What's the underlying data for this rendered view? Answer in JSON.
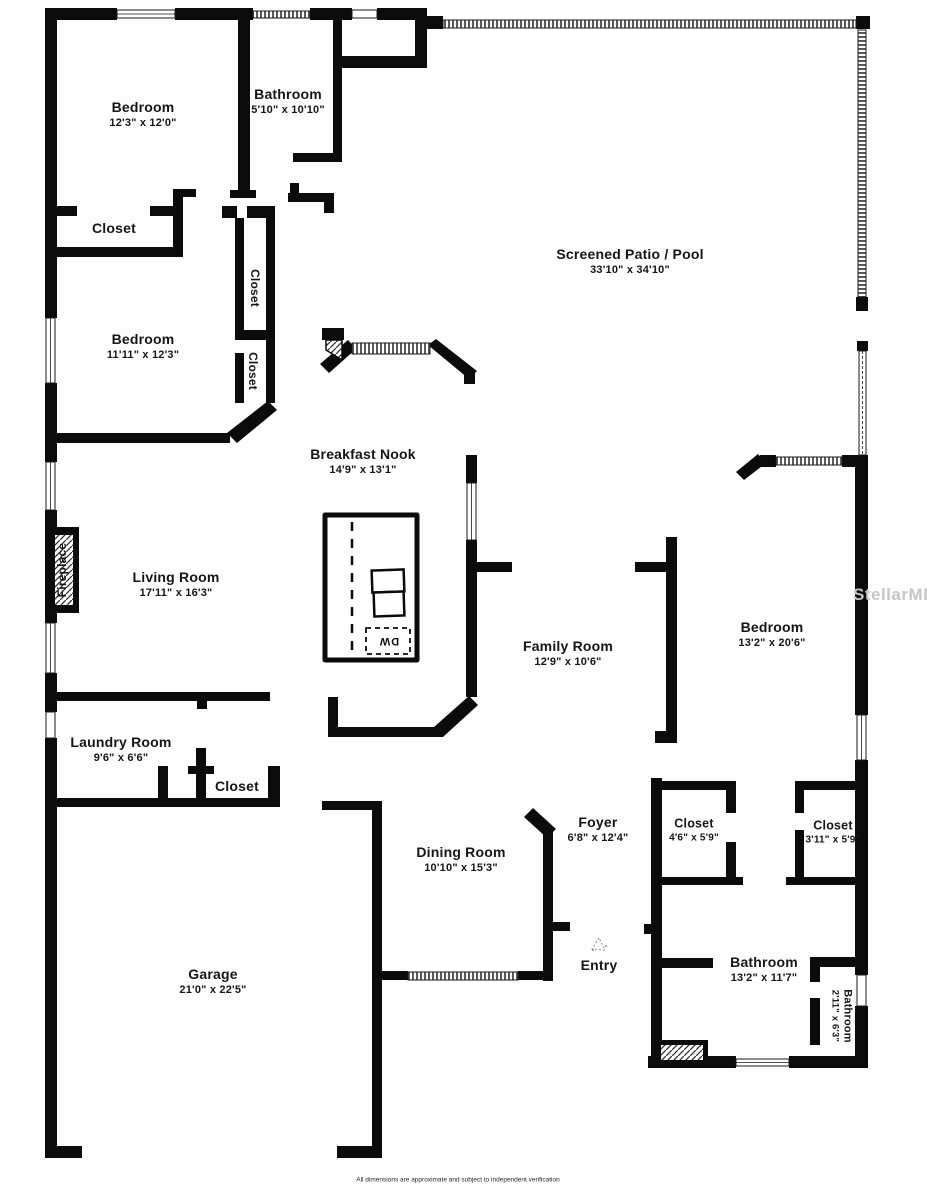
{
  "watermark": "StellarMLS",
  "disclaimer": "All dimensions are approximate and subject to independent verification",
  "colors": {
    "wall": "#0b0b0b",
    "label": "#161616",
    "watermark": "#c6c6c6",
    "background": "#fdfdfd"
  },
  "fixtures": {
    "dishwasher": "DW"
  },
  "rooms": [
    {
      "name": "Bedroom",
      "dims": "12'3\" x 12'0\""
    },
    {
      "name": "Bathroom",
      "dims": "5'10\" x 10'10\""
    },
    {
      "name": "Closet",
      "dims": ""
    },
    {
      "name": "Screened Patio / Pool",
      "dims": "33'10\" x 34'10\""
    },
    {
      "name": "Bedroom",
      "dims": "11'11\" x 12'3\""
    },
    {
      "name": "Closet",
      "dims": ""
    },
    {
      "name": "Closet",
      "dims": ""
    },
    {
      "name": "Breakfast Nook",
      "dims": "14'9\" x 13'1\""
    },
    {
      "name": "Living Room",
      "dims": "17'11\" x 16'3\""
    },
    {
      "name": "Fireplace",
      "dims": ""
    },
    {
      "name": "Family Room",
      "dims": "12'9\" x 10'6\""
    },
    {
      "name": "Bedroom",
      "dims": "13'2\" x 20'6\""
    },
    {
      "name": "Laundry Room",
      "dims": "9'6\" x 6'6\""
    },
    {
      "name": "Closet",
      "dims": ""
    },
    {
      "name": "Dining Room",
      "dims": "10'10\" x 15'3\""
    },
    {
      "name": "Foyer",
      "dims": "6'8\" x 12'4\""
    },
    {
      "name": "Closet",
      "dims": "4'6\" x 5'9\""
    },
    {
      "name": "Closet",
      "dims": "3'11\" x 5'9\""
    },
    {
      "name": "Entry",
      "dims": ""
    },
    {
      "name": "Garage",
      "dims": "21'0\" x 22'5\""
    },
    {
      "name": "Bathroom",
      "dims": "13'2\" x 11'7\""
    },
    {
      "name": "Bathroom",
      "dims": "2'11\" x 6'3\""
    }
  ]
}
